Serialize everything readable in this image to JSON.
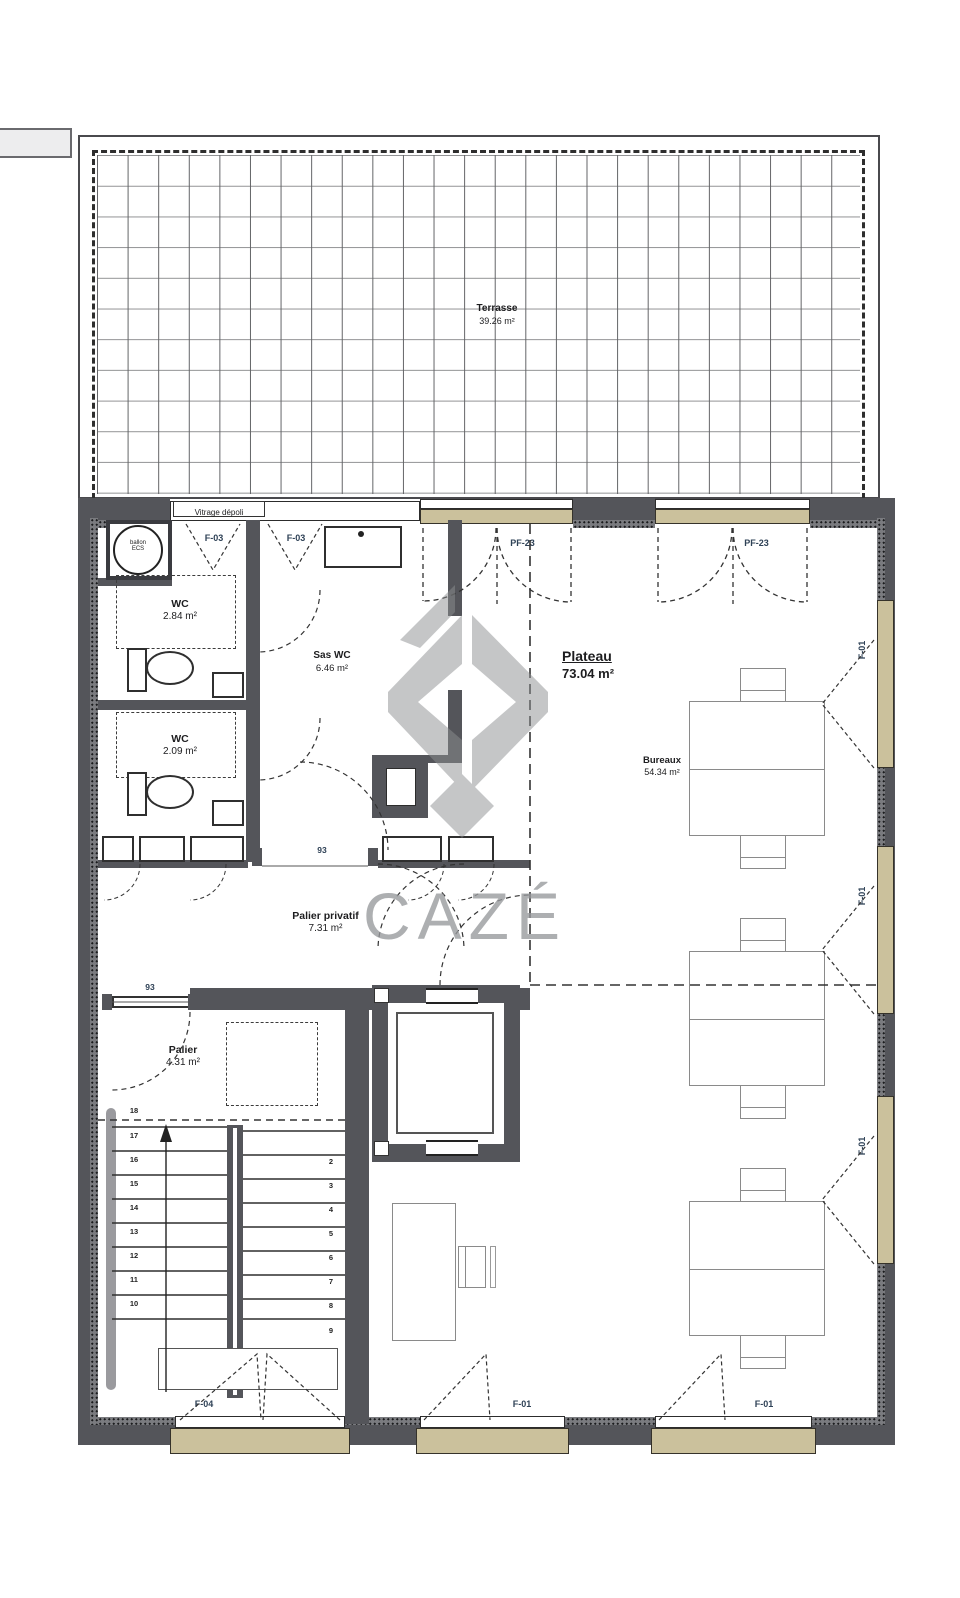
{
  "watermark": {
    "text": "CAZÉ"
  },
  "terrace": {
    "name": "Terrasse",
    "area": "39.26 m²"
  },
  "glazing": {
    "label": "Vitrage dépoli"
  },
  "window_codes": {
    "f03": "F-03",
    "pf23": "PF-23",
    "f01": "F-01",
    "f04": "F-04"
  },
  "rooms": {
    "wc1": {
      "name": "WC",
      "area": "2.84 m²"
    },
    "wc2": {
      "name": "WC",
      "area": "2.09 m²"
    },
    "sas": {
      "name": "Sas WC",
      "area": "6.46 m²"
    },
    "plateau": {
      "name": "Plateau",
      "area": "73.04 m²"
    },
    "bureaux": {
      "name": "Bureaux",
      "area": "54.34 m²"
    },
    "palier_privatif": {
      "name": "Palier privatif",
      "area": "7.31 m²"
    },
    "palier": {
      "name": "Palier",
      "area": "4.31 m²"
    }
  },
  "equipment": {
    "water_heater_line1": "ballon",
    "water_heater_line2": "ECS"
  },
  "dimensions": {
    "opening_sas": "93",
    "opening_palier": "93"
  },
  "stairs": {
    "left_numbers": [
      "18",
      "17",
      "16",
      "15",
      "14",
      "13",
      "12",
      "11",
      "10"
    ],
    "right_numbers": [
      "2",
      "3",
      "4",
      "5",
      "6",
      "7",
      "8",
      "9"
    ]
  },
  "colors": {
    "wall": "#54555a",
    "window": "#cbc19c",
    "watermark": "#97999c"
  }
}
